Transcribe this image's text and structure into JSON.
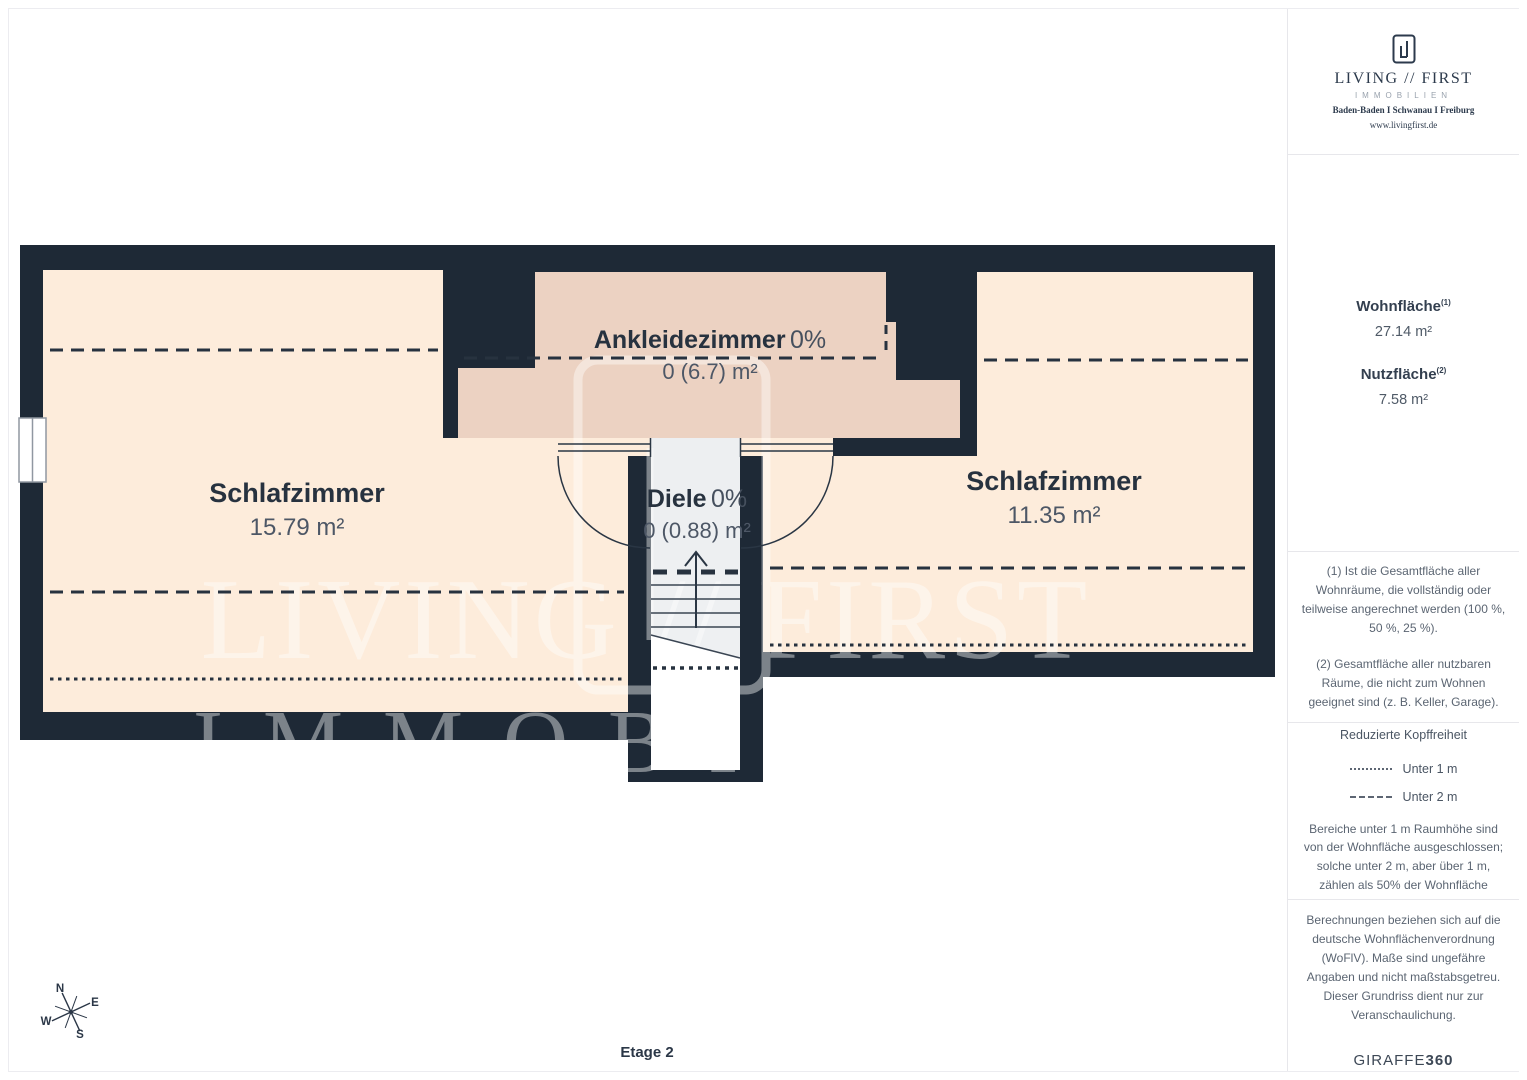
{
  "page": {
    "floor_label": "Etage 2"
  },
  "colors": {
    "wall": "#1e2936",
    "room_cream": "#fdecdb",
    "room_salmon": "#ecd2c2",
    "hall_gray": "#edeff1",
    "line_dark": "#27323f",
    "label_gray": "#4d5766"
  },
  "rooms": {
    "schlafzimmer_left": {
      "name": "Schlafzimmer",
      "area": "15.79 m²"
    },
    "ankleidezimmer": {
      "name": "Ankleidezimmer",
      "pct": "0%",
      "area": "0 (6.7) m²"
    },
    "diele": {
      "name": "Diele",
      "pct": "0%",
      "area": "0 (0.88) m²"
    },
    "schlafzimmer_right": {
      "name": "Schlafzimmer",
      "area": "11.35 m²"
    }
  },
  "compass": {
    "n": "N",
    "e": "E",
    "s": "S",
    "w": "W"
  },
  "watermark": {
    "line1": "LIVING // FIRST",
    "line2": "IMMOBILIEN"
  },
  "sidebar": {
    "logo": {
      "name": "LIVING // FIRST",
      "subtitle": "IMMOBILIEN",
      "locations": "Baden-Baden I Schwanau I Freiburg",
      "website": "www.livingfirst.de"
    },
    "metrics": [
      {
        "label": "Wohnfläche",
        "sup": "(1)",
        "value": "27.14 m²"
      },
      {
        "label": "Nutzfläche",
        "sup": "(2)",
        "value": "7.58 m²"
      }
    ],
    "notes": [
      "(1) Ist die Gesamtfläche aller Wohnräume, die vollständig oder teilweise angerechnet werden (100 %, 50 %, 25 %).",
      "(2) Gesamtfläche aller nutzbaren Räume, die nicht zum Wohnen geeignet sind (z. B. Keller, Garage)."
    ],
    "legend": {
      "title": "Reduzierte Kopffreiheit",
      "items": [
        {
          "style": "dotted",
          "label": "Unter 1 m"
        },
        {
          "style": "dashed",
          "label": "Unter 2 m"
        }
      ],
      "note": "Bereiche unter 1 m Raumhöhe sind von der Wohnfläche ausgeschlossen; solche unter 2 m, aber über 1 m, zählen als 50% der Wohnfläche"
    },
    "disclaimer": "Berechnungen beziehen sich auf die deutsche Wohnflächenverordnung (WoFlV). Maße sind ungefähre Angaben und nicht maßstabsgetreu. Dieser Grundriss dient nur zur Veranschaulichung.",
    "brand": {
      "name": "GIRAFFE",
      "suffix": "360"
    }
  }
}
